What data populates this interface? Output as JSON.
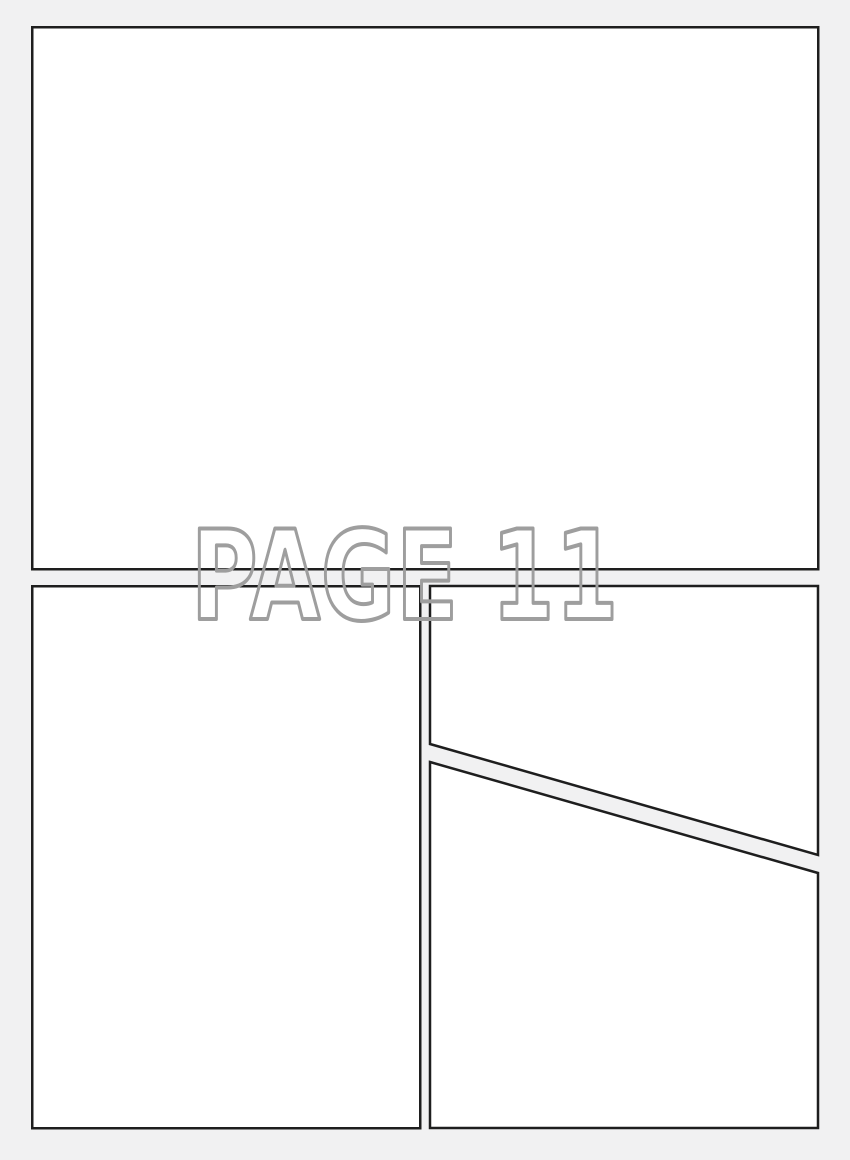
{
  "watermark": {
    "text": "PAGE 11"
  },
  "colors": {
    "background": "#f1f1f2",
    "panel_fill": "#ffffff",
    "panel_border": "#1e1e1e",
    "watermark_outline": "#9e9e9e"
  }
}
